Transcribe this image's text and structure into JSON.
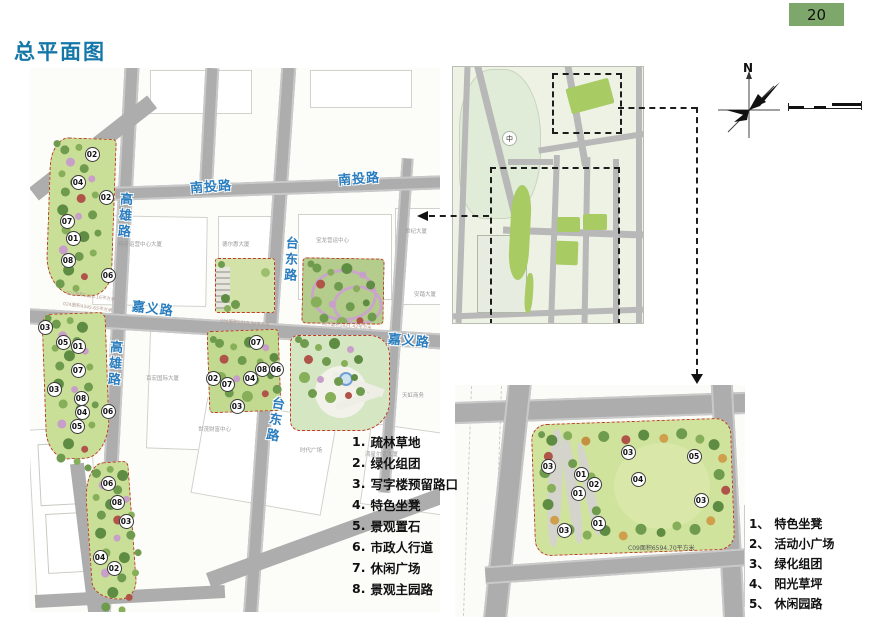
{
  "page": {
    "title": "总平面图",
    "number": "20"
  },
  "colors": {
    "page_number_bg": "#7ea76b",
    "title_blue": "#1577a8",
    "street_label_blue": "#2a7dbe",
    "park_border_red": "#c0392b",
    "park_green": "#c9df97",
    "road_gray": "#adadad",
    "overview_park_green": "#a8cb64"
  },
  "main_map": {
    "street_labels": [
      {
        "text": "南投路",
        "x": 160,
        "y": 108,
        "rot": -4
      },
      {
        "text": "南投路",
        "x": 308,
        "y": 100,
        "rot": -4
      },
      {
        "text": "高雄路",
        "x": 84,
        "y": 124,
        "orient": "v",
        "rot": 4
      },
      {
        "text": "高雄路",
        "x": 74,
        "y": 272,
        "orient": "v",
        "rot": 4
      },
      {
        "text": "台东路",
        "x": 250,
        "y": 168,
        "orient": "v",
        "rot": 3
      },
      {
        "text": "台东路",
        "x": 234,
        "y": 328,
        "orient": "v",
        "rot": 10
      },
      {
        "text": "嘉义路",
        "x": 102,
        "y": 230,
        "rot": 7
      },
      {
        "text": "嘉义路",
        "x": 358,
        "y": 262,
        "rot": 5
      }
    ],
    "building_labels": [
      {
        "text": "特步运营中心大厦",
        "x": 88,
        "y": 172
      },
      {
        "text": "德尔惠大厦",
        "x": 192,
        "y": 172
      },
      {
        "text": "宝龙营运中心",
        "x": 286,
        "y": 168
      },
      {
        "text": "百宏国际大厦",
        "x": 116,
        "y": 306
      },
      {
        "text": "世茂财富中心",
        "x": 168,
        "y": 357
      },
      {
        "text": "时代广场",
        "x": 270,
        "y": 378
      },
      {
        "text": "鸿星尔克大厦",
        "x": 335,
        "y": 382
      },
      {
        "text": "天虹商务",
        "x": 372,
        "y": 323
      },
      {
        "text": "安踏大厦",
        "x": 384,
        "y": 222
      }
    ],
    "area_labels": [
      {
        "text": "023面积1226.16平方米",
        "x": 36,
        "y": 222,
        "rot": 8
      },
      {
        "text": "024面积4345.65平方米",
        "x": 33,
        "y": 233,
        "rot": 8
      },
      {
        "text": "026面积1219.36平方米",
        "x": 190,
        "y": 250,
        "rot": 5
      },
      {
        "text": "027面积1821.42平方米",
        "x": 292,
        "y": 253,
        "rot": 5
      }
    ],
    "markers": [
      {
        "text": "02",
        "x": 62,
        "y": 86
      },
      {
        "text": "04",
        "x": 48,
        "y": 114
      },
      {
        "text": "02",
        "x": 76,
        "y": 129
      },
      {
        "text": "07",
        "x": 37,
        "y": 153
      },
      {
        "text": "01",
        "x": 43,
        "y": 170
      },
      {
        "text": "08",
        "x": 38,
        "y": 192
      },
      {
        "text": "06",
        "x": 78,
        "y": 207
      },
      {
        "text": "03",
        "x": 15,
        "y": 259
      },
      {
        "text": "05",
        "x": 33,
        "y": 274
      },
      {
        "text": "01",
        "x": 48,
        "y": 278
      },
      {
        "text": "07",
        "x": 48,
        "y": 302
      },
      {
        "text": "03",
        "x": 24,
        "y": 321
      },
      {
        "text": "08",
        "x": 51,
        "y": 330
      },
      {
        "text": "04",
        "x": 52,
        "y": 344
      },
      {
        "text": "05",
        "x": 47,
        "y": 358
      },
      {
        "text": "06",
        "x": 78,
        "y": 343
      },
      {
        "text": "07",
        "x": 226,
        "y": 274
      },
      {
        "text": "08",
        "x": 232,
        "y": 301
      },
      {
        "text": "06",
        "x": 246,
        "y": 301
      },
      {
        "text": "02",
        "x": 183,
        "y": 310
      },
      {
        "text": "07",
        "x": 197,
        "y": 316
      },
      {
        "text": "04",
        "x": 220,
        "y": 310
      },
      {
        "text": "03",
        "x": 207,
        "y": 338
      },
      {
        "text": "06",
        "x": 78,
        "y": 415
      },
      {
        "text": "08",
        "x": 87,
        "y": 434
      },
      {
        "text": "03",
        "x": 96,
        "y": 453
      },
      {
        "text": "04",
        "x": 70,
        "y": 489
      },
      {
        "text": "02",
        "x": 84,
        "y": 500
      }
    ]
  },
  "legend_main": {
    "items": [
      {
        "no": "1.",
        "text": "疏林草地"
      },
      {
        "no": "2.",
        "text": "绿化组团"
      },
      {
        "no": "3.",
        "text": "写字楼预留路口"
      },
      {
        "no": "4.",
        "text": "特色坐凳"
      },
      {
        "no": "5.",
        "text": "景观置石"
      },
      {
        "no": "6.",
        "text": "市政人行道"
      },
      {
        "no": "7.",
        "text": "休闲广场"
      },
      {
        "no": "8.",
        "text": "景观主园路"
      }
    ]
  },
  "legend_detail": {
    "items": [
      {
        "no": "1、",
        "text": "特色坐凳"
      },
      {
        "no": "2、",
        "text": "活动小广场"
      },
      {
        "no": "3、",
        "text": "绿化组团"
      },
      {
        "no": "4、",
        "text": "阳光草坪"
      },
      {
        "no": "5、",
        "text": "休闲园路"
      }
    ]
  },
  "overview_map": {
    "center_label": "中"
  },
  "compass": {
    "north_label": "N"
  },
  "connector": {
    "label": "世纪大厦"
  },
  "detail_map": {
    "caption": "C09面积6594.70平方米",
    "markers": [
      {
        "text": "03",
        "x": 93,
        "y": 81
      },
      {
        "text": "01",
        "x": 126,
        "y": 89
      },
      {
        "text": "02",
        "x": 139,
        "y": 99
      },
      {
        "text": "01",
        "x": 123,
        "y": 108
      },
      {
        "text": "03",
        "x": 173,
        "y": 67
      },
      {
        "text": "04",
        "x": 183,
        "y": 94
      },
      {
        "text": "05",
        "x": 239,
        "y": 71
      },
      {
        "text": "03",
        "x": 246,
        "y": 115
      },
      {
        "text": "01",
        "x": 143,
        "y": 138
      },
      {
        "text": "03",
        "x": 109,
        "y": 145
      }
    ]
  }
}
